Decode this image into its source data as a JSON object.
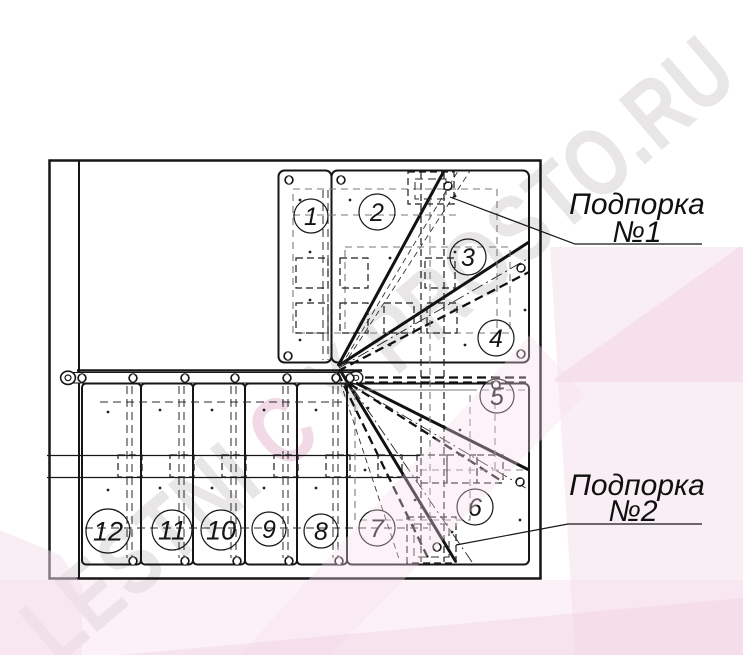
{
  "watermark": {
    "part1": "LESTNI",
    "part2": "C",
    "part3": "Y PROSTO.RU"
  },
  "labels": {
    "support1": {
      "line1": "Подпорка",
      "line2": "№1"
    },
    "support2": {
      "line1": "Подпорка",
      "line2": "№2"
    }
  },
  "steps": [
    {
      "number": "1"
    },
    {
      "number": "2"
    },
    {
      "number": "3"
    },
    {
      "number": "4"
    },
    {
      "number": "5"
    },
    {
      "number": "6"
    },
    {
      "number": "7"
    },
    {
      "number": "8"
    },
    {
      "number": "9"
    },
    {
      "number": "10"
    },
    {
      "number": "11"
    },
    {
      "number": "12"
    }
  ],
  "colors": {
    "ink": "#161616",
    "watermark_gray": "#e8e6e7",
    "watermark_pink": "#f2d9e6",
    "pink_overlay": "#f6ddeb",
    "pink_overlay_dark": "#f0cfe2"
  }
}
